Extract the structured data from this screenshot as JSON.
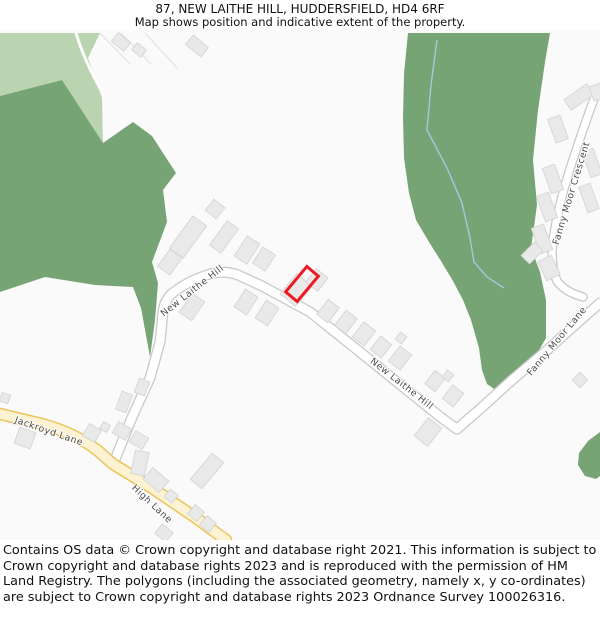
{
  "header": {
    "title": "87, NEW LAITHE HILL, HUDDERSFIELD, HD4 6RF",
    "subtitle": "Map shows position and indicative extent of the property."
  },
  "footer": {
    "attribution": "Contains OS data © Crown copyright and database right 2021. This information is subject to Crown copyright and database rights 2023 and is reproduced with the permission of HM Land Registry. The polygons (including the associated geometry, namely x, y co-ordinates) are subject to Crown copyright and database rights 2023 Ordnance Survey 100026316."
  },
  "map": {
    "colors": {
      "background": "#fafafa",
      "dark_green": "#76a474",
      "light_green": "#bad4b1",
      "building": "#e9e9e9",
      "building_stroke": "#d2d2d2",
      "road_casing": "#c9c9c9",
      "road_fill": "#ffffff",
      "yellow_casing": "#ecc35c",
      "yellow_fill": "#fdf3d3",
      "stream": "#a5c8dd",
      "property": "#ec1b23",
      "label": "#4d4d4d"
    },
    "green_areas": [
      {
        "name": "field-light-top-left",
        "shade": "light",
        "points": "0,33 100,33 88,58 102,98 103,143 62,80 0,96"
      },
      {
        "name": "woodland-left",
        "shade": "dark",
        "points": "0,96 62,80 103,143 133,122 152,136 176,173 163,190 167,222 152,262 158,283 155,320 150,357 141,308 133,287 95,285 45,277 0,292"
      },
      {
        "name": "woodland-right",
        "shade": "dark",
        "points": "408,33 550,33 545,62 538,110 533,160 537,205 531,248 540,272 546,300 546,338 538,352 524,366 509,381 497,391 487,384 482,370 479,348 471,320 463,300 453,281 441,261 429,242 416,220 409,193 404,158 403,118 404,74"
      },
      {
        "name": "woodland-right-edge",
        "shade": "dark",
        "points": "600,432 588,441 579,453 578,465 585,476 596,479 600,476"
      }
    ],
    "field_lines": [
      [
        100,
        33,
        130,
        64
      ],
      [
        121,
        33,
        151,
        64
      ],
      [
        145,
        33,
        178,
        69
      ]
    ],
    "green_paths": [
      "M76,33 Q84,60 101,90"
    ],
    "stream": {
      "d": "M437,40 L431,85 L427,130 L447,168 L462,203 L470,238 L474,262 L487,277 L504,288"
    },
    "roads": [
      {
        "name": "new-laithe-hill",
        "style": "white",
        "w": 8.5,
        "d": "M114,462 L133,415 L150,378 L160,342 L163,312 Q165,298 174,292 Q188,281 210,274 Q225,270 238,275 L262,286 L310,312 L360,352 L408,391 L443,419 L457,429"
      },
      {
        "name": "fanny-moor-lane",
        "style": "white",
        "w": 8.5,
        "d": "M457,429 L480,409 L512,380 L545,352 L575,325 L600,303"
      },
      {
        "name": "fanny-moor-crescent",
        "style": "white",
        "w": 7,
        "d": "M597,91 Q583,128 569,172 Q558,207 553,240 Q550,266 557,281 Q565,292 583,297"
      },
      {
        "name": "jackroyd-lane-high-lane",
        "style": "yellow",
        "w": 9.5,
        "d": "M0,414 L42,424 Q75,433 97,450 L113,464 L152,488 L196,518 L226,540"
      }
    ],
    "buildings": [
      [
        121,
        42,
        16,
        11,
        40
      ],
      [
        139,
        50,
        12,
        9,
        40
      ],
      [
        197,
        46,
        20,
        12,
        40
      ],
      [
        215,
        209,
        14,
        14,
        38
      ],
      [
        188,
        237,
        17,
        40,
        36
      ],
      [
        224,
        237,
        14,
        30,
        36
      ],
      [
        170,
        262,
        15,
        21,
        36
      ],
      [
        247,
        250,
        15,
        24,
        33
      ],
      [
        264,
        259,
        15,
        19,
        33
      ],
      [
        296,
        290,
        20,
        26,
        40
      ],
      [
        317,
        280,
        15,
        17,
        38
      ],
      [
        328,
        311,
        14,
        19,
        38
      ],
      [
        346,
        322,
        14,
        19,
        38
      ],
      [
        364,
        334,
        15,
        19,
        38
      ],
      [
        381,
        347,
        14,
        17,
        38
      ],
      [
        401,
        338,
        8,
        9,
        38
      ],
      [
        400,
        358,
        15,
        19,
        38
      ],
      [
        192,
        307,
        15,
        23,
        35
      ],
      [
        246,
        302,
        15,
        21,
        33
      ],
      [
        267,
        313,
        15,
        21,
        33
      ],
      [
        435,
        381,
        13,
        17,
        38
      ],
      [
        448,
        376,
        8,
        9,
        38
      ],
      [
        453,
        396,
        14,
        17,
        38
      ],
      [
        428,
        432,
        17,
        23,
        38
      ],
      [
        580,
        380,
        11,
        11,
        45
      ],
      [
        142,
        387,
        11,
        15,
        20
      ],
      [
        124,
        402,
        11,
        19,
        20
      ],
      [
        122,
        431,
        15,
        13,
        30
      ],
      [
        139,
        440,
        15,
        13,
        30
      ],
      [
        92,
        433,
        14,
        14,
        30
      ],
      [
        105,
        427,
        8,
        8,
        30
      ],
      [
        25,
        438,
        17,
        17,
        20
      ],
      [
        5,
        398,
        9,
        9,
        20
      ],
      [
        140,
        463,
        14,
        24,
        12
      ],
      [
        156,
        480,
        21,
        15,
        40
      ],
      [
        171,
        496,
        10,
        10,
        40
      ],
      [
        207,
        471,
        15,
        34,
        40
      ],
      [
        196,
        513,
        12,
        12,
        40
      ],
      [
        208,
        524,
        12,
        12,
        40
      ],
      [
        164,
        533,
        14,
        12,
        40
      ],
      [
        579,
        97,
        28,
        13,
        -35
      ],
      [
        597,
        92,
        12,
        15,
        -20
      ],
      [
        558,
        129,
        13,
        25,
        -20
      ],
      [
        553,
        179,
        13,
        27,
        -20
      ],
      [
        547,
        207,
        13,
        27,
        -20
      ],
      [
        542,
        239,
        13,
        27,
        -20
      ],
      [
        549,
        268,
        15,
        21,
        -25
      ],
      [
        532,
        253,
        19,
        12,
        -45
      ],
      [
        592,
        163,
        12,
        27,
        -20
      ],
      [
        589,
        198,
        12,
        27,
        -20
      ]
    ],
    "property": {
      "cx": 302,
      "cy": 284,
      "w": 15,
      "h": 33,
      "rotate": 40
    },
    "road_labels": [
      {
        "text": "New Laithe Hill",
        "x": 194,
        "y": 293,
        "rotate": -38
      },
      {
        "text": "New Laithe Hill",
        "x": 400,
        "y": 386,
        "rotate": 38
      },
      {
        "text": "Fanny Moor Crescent",
        "x": 574,
        "y": 194,
        "rotate": -73
      },
      {
        "text": "Fanny Moor Lane",
        "x": 559,
        "y": 343,
        "rotate": -50
      },
      {
        "text": "Jackroyd Lane",
        "x": 48,
        "y": 434,
        "rotate": 19
      },
      {
        "text": "High Lane",
        "x": 150,
        "y": 506,
        "rotate": 43
      }
    ]
  }
}
